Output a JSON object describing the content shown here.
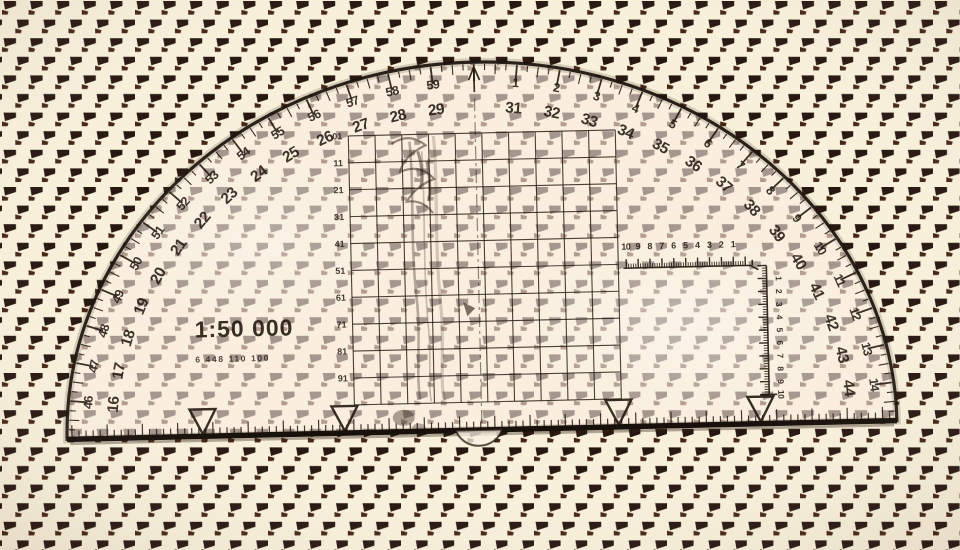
{
  "protractor": {
    "scale_label": "1:50 000",
    "stock_number": "6 448 110 100",
    "arc_labels": [
      {
        "unit": 16,
        "inner": "16",
        "outer": "46"
      },
      {
        "unit": 17,
        "inner": "17",
        "outer": "47"
      },
      {
        "unit": 18,
        "inner": "18",
        "outer": "48"
      },
      {
        "unit": 19,
        "inner": "19",
        "outer": "49"
      },
      {
        "unit": 20,
        "inner": "20",
        "outer": "50"
      },
      {
        "unit": 21,
        "inner": "21",
        "outer": "51"
      },
      {
        "unit": 22,
        "inner": "22",
        "outer": "52"
      },
      {
        "unit": 23,
        "inner": "23",
        "outer": "53"
      },
      {
        "unit": 24,
        "inner": "24",
        "outer": "54"
      },
      {
        "unit": 25,
        "inner": "25",
        "outer": "55"
      },
      {
        "unit": 26,
        "inner": "26",
        "outer": "56"
      },
      {
        "unit": 27,
        "inner": "27",
        "outer": "57"
      },
      {
        "unit": 28,
        "inner": "28",
        "outer": "58"
      },
      {
        "unit": 29,
        "inner": "29",
        "outer": "59"
      },
      {
        "unit": 31,
        "inner": "31",
        "outer": "1"
      },
      {
        "unit": 32,
        "inner": "32",
        "outer": "2"
      },
      {
        "unit": 33,
        "inner": "33",
        "outer": "3"
      },
      {
        "unit": 34,
        "inner": "34",
        "outer": "4"
      },
      {
        "unit": 35,
        "inner": "35",
        "outer": "5"
      },
      {
        "unit": 36,
        "inner": "36",
        "outer": "6"
      },
      {
        "unit": 37,
        "inner": "37",
        "outer": "7"
      },
      {
        "unit": 38,
        "inner": "38",
        "outer": "8"
      },
      {
        "unit": 39,
        "inner": "39",
        "outer": "9"
      },
      {
        "unit": 40,
        "inner": "40",
        "outer": "10"
      },
      {
        "unit": 41,
        "inner": "41",
        "outer": "11"
      },
      {
        "unit": 42,
        "inner": "42",
        "outer": "12"
      },
      {
        "unit": 43,
        "inner": "43",
        "outer": "13"
      },
      {
        "unit": 44,
        "inner": "44",
        "outer": "14"
      }
    ],
    "grid_row_labels": [
      "01",
      "11",
      "21",
      "31",
      "41",
      "51",
      "61",
      "71",
      "81",
      "91"
    ],
    "top_ruler_labels": [
      "10",
      "9",
      "8",
      "7",
      "6",
      "5",
      "4",
      "3",
      "2",
      "1"
    ],
    "side_ruler_labels": [
      "1",
      "2",
      "3",
      "4",
      "5",
      "6",
      "7",
      "8",
      "9",
      "10"
    ]
  },
  "colors": {
    "background": "#f8f0db",
    "pattern_dark": "#271711",
    "pattern_accent": "#452616",
    "ink": "#221810"
  }
}
